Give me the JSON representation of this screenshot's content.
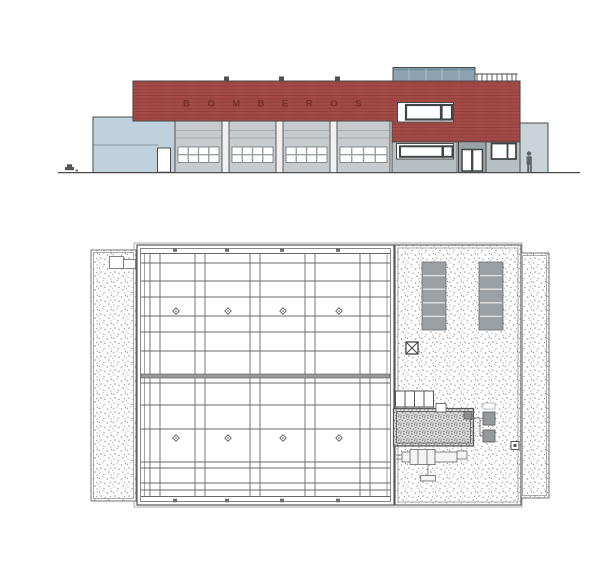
{
  "drawing": {
    "sheet_type": "architectural drawing",
    "views": [
      "front elevation",
      "roof plan"
    ]
  },
  "colors": {
    "line": "#4a4a4a",
    "brick_red": "#a34a46",
    "brick_joint": "#8a3a37",
    "light_blue_wall": "#bed1dc",
    "garage_door": "#c7cbcd",
    "rooftop_unit": "#8ca3b2",
    "facade_gray": "#b9c0c3",
    "right_volume": "#c9d2d7",
    "panel_gray": "#9aa0a4",
    "stipple_dot": "#9b9b9b",
    "glass_white": "#ffffff"
  },
  "elevation": {
    "sign_text": "BOMBEROS",
    "sign_x": 183,
    "sign_y": 106.5,
    "garage_bays": [
      {
        "x": 175,
        "w": 47
      },
      {
        "x": 229,
        "w": 47
      },
      {
        "x": 283,
        "w": 47
      },
      {
        "x": 337,
        "w": 53
      }
    ],
    "garage_window_cols": 4,
    "garage_window_rows": 2,
    "parapet_vent_xs": [
      224,
      279,
      335
    ],
    "railing_post_xs": [
      477,
      482,
      487,
      492,
      497,
      502,
      507,
      512,
      516
    ],
    "rooftop_unit_divider_xs": [
      409,
      426,
      442,
      459
    ]
  },
  "plan": {
    "grid": {
      "x_start": 141,
      "x_end": 390,
      "y_start": 253,
      "y_end": 497,
      "vertical_pair_xs": [
        150,
        160,
        195,
        205,
        250,
        260,
        305,
        315,
        360,
        370
      ],
      "vertical_single_xs": [
        144.5,
        387
      ],
      "horizontal_ys": [
        253.5,
        263,
        281,
        297,
        316,
        332,
        351,
        383,
        405,
        429,
        462,
        468,
        483,
        490,
        496.5
      ],
      "thick_band": {
        "y": 374,
        "h": 4
      },
      "drain_row_ys": [
        311,
        438
      ],
      "drain_xs": [
        176,
        228,
        283,
        339
      ],
      "edge_marker_xs": [
        175,
        227,
        282,
        338
      ],
      "edge_marker_ys": [
        250,
        500.5
      ]
    },
    "solar_panels": {
      "xs": [
        422,
        479
      ],
      "y": 262,
      "w": 24,
      "h": 68,
      "segments": 5
    }
  }
}
